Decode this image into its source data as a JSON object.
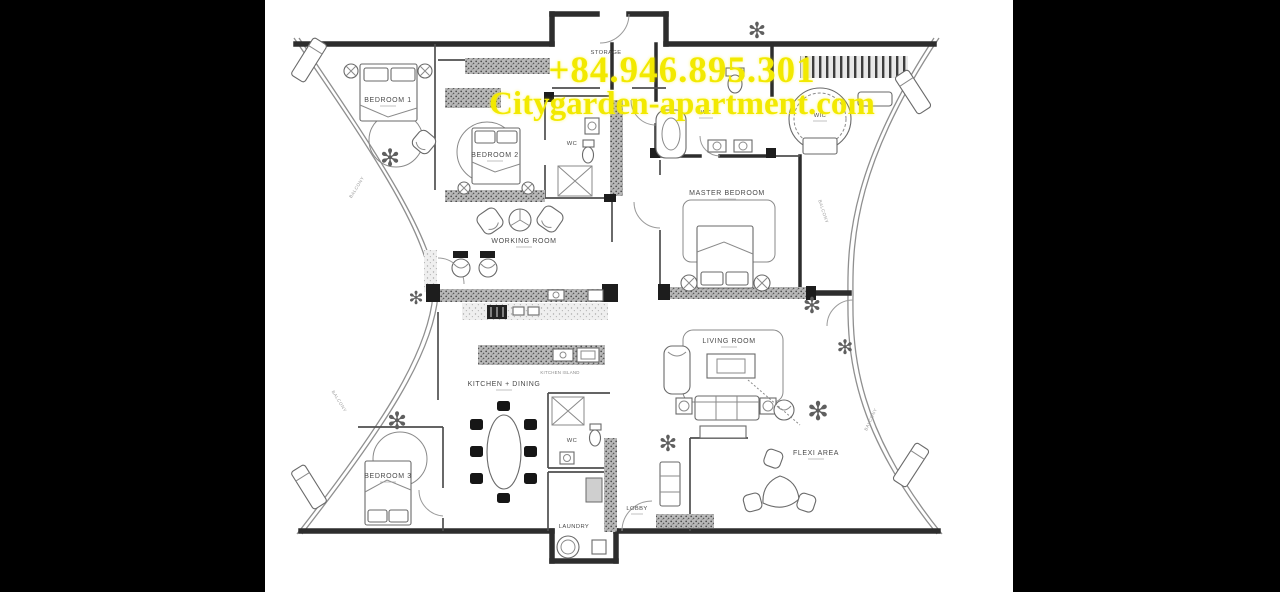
{
  "watermark": {
    "phone": "+84.946.895.301",
    "website": "Citygarden-apartment.com",
    "color": "#f2e900"
  },
  "canvas": {
    "background": "#000000",
    "paper": "#ffffff"
  },
  "icons": {
    "plant": "✻"
  },
  "floor_plan": {
    "balcony_label": "BALCONY",
    "rooms": [
      {
        "label": "STORAGE"
      },
      {
        "label": "BEDROOM 1"
      },
      {
        "label": "BEDROOM 2"
      },
      {
        "label": "WC"
      },
      {
        "label": "WC"
      },
      {
        "label": "WIC"
      },
      {
        "label": "MASTER BEDROOM"
      },
      {
        "label": "WORKING ROOM"
      },
      {
        "label": "LIVING ROOM"
      },
      {
        "label": "KITCHEN + DINING"
      },
      {
        "label": "KITCHEN ISLAND"
      },
      {
        "label": "WC"
      },
      {
        "label": "BEDROOM 3"
      },
      {
        "label": "LAUNDRY"
      },
      {
        "label": "LOBBY"
      },
      {
        "label": "FLEXI AREA"
      }
    ]
  }
}
